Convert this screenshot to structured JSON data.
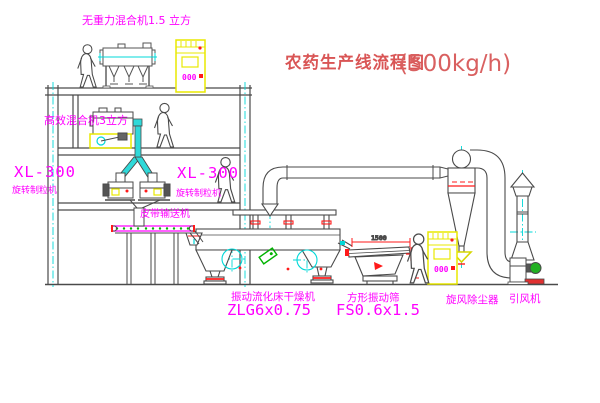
{
  "canvas": {
    "width": 600,
    "height": 403,
    "background": "#ffffff"
  },
  "colors": {
    "line": "#4a4a4a",
    "cyan": "#00d8d8",
    "yellow": "#e8e800",
    "magenta": "#ff00ff",
    "red": "#ff1a1a",
    "green": "#00b300",
    "title_red": "#d95555"
  },
  "labels": {
    "title_main": "农药生产线流程图",
    "title_capacity": "(500kg/h)",
    "gravity_mixer": "无重力混合机1.5 立方",
    "high_speed_mixer": "高效混合机3立方",
    "granulator_left_model": "XL-300",
    "granulator_left_name": "旋转制粒机",
    "granulator_mid_model": "XL-300",
    "granulator_mid_name": "旋转制粒机",
    "belt_conveyor": "皮带输送机",
    "dryer_name": "振动流化床干燥机",
    "dryer_model": "ZLG6x0.75",
    "sieve_name": "方形振动筛",
    "sieve_model": "FS0.6x1.5",
    "sieve_dim": "1500",
    "cyclone": "旋风除尘器",
    "induced_fan": "引风机",
    "panel_display": "000"
  }
}
